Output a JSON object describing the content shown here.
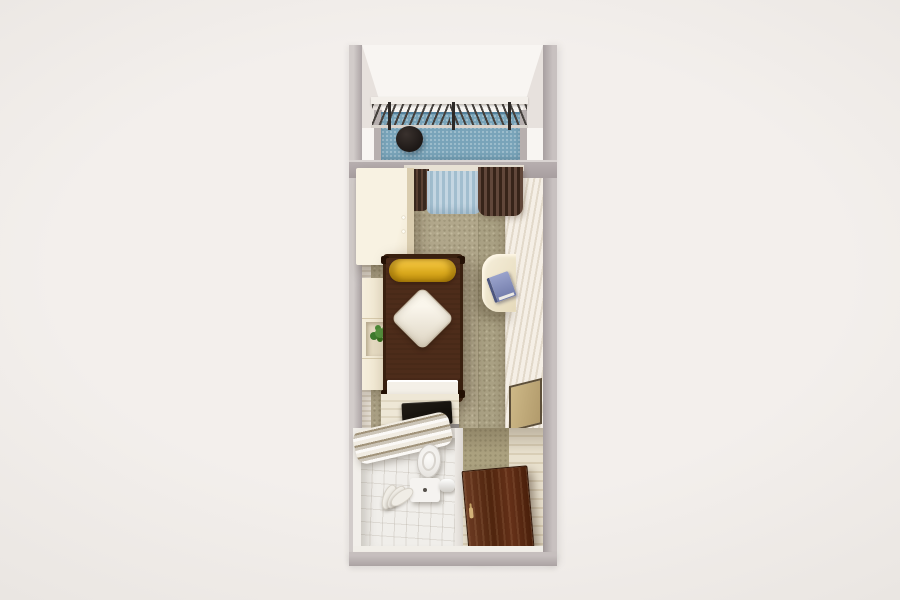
{
  "scene": {
    "title": "3D top-down render of a narrow studio apartment floor plan",
    "background": "#f1ede9"
  },
  "palette": {
    "background": "#f1ede9",
    "outer_wall": "#aca4a5",
    "inner_wall_white": "#f8f5f2",
    "wall_paneling_cream": "#efe8df",
    "balcony_floor_blue": "#79a4b9",
    "balcony_table_black": "#1d1816",
    "railing_bar_dark": "#45403c",
    "curtain_brown": "#4a362b",
    "curtain_sheer_blue": "#b3cad9",
    "carpet_tan": "#b1a78b",
    "wardrobe_cream": "#f4edda",
    "bed_frame_dark_brown": "#39200f",
    "bed_cover_brown": "#4d2c1a",
    "bolster_yellow": "#e0ab1d",
    "pillow_offwhite": "#f0eadd",
    "plant_green": "#55923e",
    "desk_cream": "#eee5cc",
    "book_blue": "#828bb8",
    "kitchen_wood_light": "#e8e0cd",
    "tray_black": "#15110d",
    "bath_floor_white": "#f0eeea",
    "shower_curtain_tan": "#a1937a",
    "hall_wood_light": "#e2d8c2",
    "door_brown": "#572a13",
    "door_handle_gold": "#d3b279",
    "wall_cabinet_tan": "#c4af7e"
  },
  "regions": {
    "stage": {
      "label": "Apartment floor plan render"
    },
    "balcony": {
      "label": "Balcony"
    },
    "railing": {
      "label": "Balcony railing"
    },
    "balconyTable": {
      "label": "Round balcony table"
    },
    "windowWall": {
      "label": "Window wall between balcony and room"
    },
    "curtains": {
      "label": "Window curtains"
    },
    "room": {
      "label": "Main room carpet"
    },
    "wardrobe": {
      "label": "Wardrobe"
    },
    "bed": {
      "label": "Bed with brown cover"
    },
    "bolster": {
      "label": "Yellow bolster pillow"
    },
    "pillow": {
      "label": "Diamond pillow"
    },
    "shelf": {
      "label": "Shelf unit"
    },
    "plant": {
      "label": "Potted plant"
    },
    "desk": {
      "label": "Wall-mounted desk"
    },
    "book": {
      "label": "Book on desk"
    },
    "wallPanels": {
      "label": "Hallway wall cabinets"
    },
    "kitchenTable": {
      "label": "Kitchenette counter"
    },
    "tray": {
      "label": "Black tray"
    },
    "appliance": {
      "label": "Grey appliance"
    },
    "bathroom": {
      "label": "Bathroom"
    },
    "showerCurtain": {
      "label": "Folded shower curtain"
    },
    "toilet": {
      "label": "Toilet"
    },
    "towel": {
      "label": "Towel on bathroom floor"
    },
    "hall": {
      "label": "Entry hall"
    },
    "door": {
      "label": "Entrance door"
    },
    "walls": {
      "label": "Apartment outer walls"
    }
  }
}
